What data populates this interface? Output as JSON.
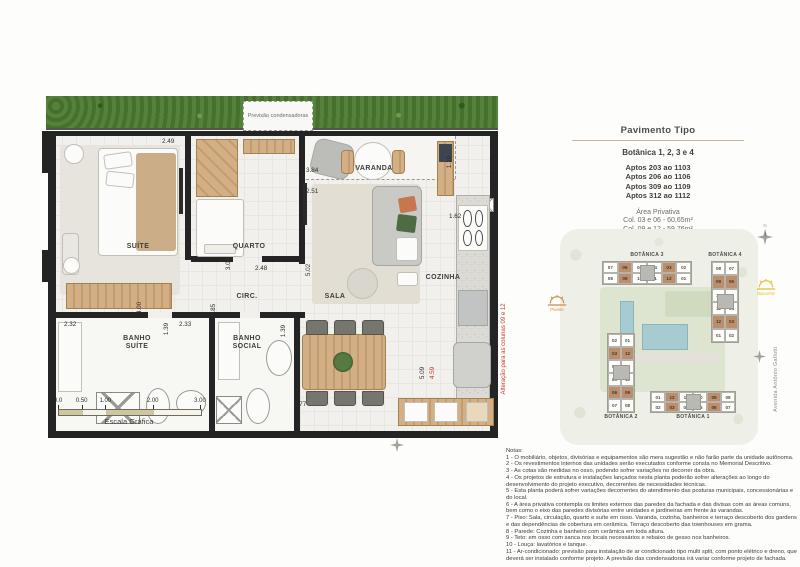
{
  "floorplan": {
    "rooms": {
      "suite": "SUÍTE",
      "quarto": "QUARTO",
      "varanda": "VARANDA",
      "sala": "SALA",
      "cozinha": "COZINHA",
      "circ": "CIRC.",
      "banho_suite": "BANHO SUÍTE",
      "banho_social": "BANHO SOCIAL"
    },
    "dims": {
      "suite_top": "2.49",
      "varanda_width": "3.84",
      "varanda_depth": "1.19",
      "sala_width": "2.51",
      "quarto_depth": "3.04",
      "quarto_width": "2.48",
      "sala_depth": "5.02",
      "circ_width": "0.85",
      "suite_depth": "4.00",
      "banho_suite_width": "2.32",
      "banho_suite_depth": "1.39",
      "banho_social_width": "2.33",
      "banho_social_depth": "1.39",
      "cozinha_width": "1.62",
      "cozinha_depth": "5.09",
      "cozinha_depth_alt": "4.59",
      "dining_width": "2.77"
    },
    "condensers_label": "Previsão condensadoras",
    "alteration_note": "Alteração para as colunas 09 e 12",
    "scale": {
      "ticks": [
        "0.0",
        "0.50",
        "1.00",
        "2.00",
        "3.00"
      ],
      "label": "Escala Gráfica"
    }
  },
  "panel": {
    "title": "Pavimento Tipo",
    "subtitle": "Botânica 1, 2, 3 e 4",
    "aptos": [
      "Aptos 203 ao 1103",
      "Aptos 206 ao 1106",
      "Aptos 309 ao 1109",
      "Aptos 312 ao 1112"
    ],
    "area_privativa": {
      "title": "Área Privativa",
      "lines": [
        "Col. 03 e 06 - 60,65m²",
        "Col. 09 e 12 - 59,76m²"
      ]
    }
  },
  "keyplan": {
    "buildings": [
      {
        "name": "BOTÂNICA 3",
        "orientation": "horizontal",
        "rows": [
          [
            "07",
            "06",
            "05",
            "04",
            "03",
            "02"
          ],
          [
            "08",
            "09",
            "10",
            "11",
            "12",
            "01"
          ]
        ],
        "highlighted": [
          "06",
          "03",
          "09",
          "12"
        ]
      },
      {
        "name": "BOTÂNICA 4",
        "orientation": "vertical",
        "rows": [
          [
            "08",
            "07"
          ],
          [
            "09",
            "06"
          ],
          [
            "10",
            "05"
          ],
          [
            "11",
            "04"
          ],
          [
            "12",
            "03"
          ],
          [
            "01",
            "02"
          ]
        ],
        "highlighted": [
          "09",
          "06",
          "12",
          "03"
        ]
      },
      {
        "name": "BOTÂNICA 2",
        "orientation": "vertical",
        "rows": [
          [
            "02",
            "01"
          ],
          [
            "03",
            "12"
          ],
          [
            "04",
            "11"
          ],
          [
            "05",
            "10"
          ],
          [
            "06",
            "09"
          ],
          [
            "07",
            "08"
          ]
        ],
        "highlighted": [
          "03",
          "12",
          "06",
          "09"
        ]
      },
      {
        "name": "BOTÂNICA 1",
        "orientation": "horizontal",
        "rows": [
          [
            "01",
            "12",
            "11",
            "10",
            "09",
            "08"
          ],
          [
            "02",
            "03",
            "04",
            "05",
            "06",
            "07"
          ]
        ],
        "highlighted": [
          "12",
          "09",
          "03",
          "06"
        ]
      }
    ],
    "street": "Avenida Antônio Gallotti",
    "sun_west": "Poente",
    "sun_east": "Nascente",
    "north": "N"
  },
  "notes": {
    "title": "Notas:",
    "items": [
      "1 - O mobiliário, objetos, divisórias e equipamentos são mera sugestão e não farão parte da unidade autônoma.",
      "2 - Os revestimentos internos das unidades serão executados conforme consta no Memorial Descritivo.",
      "3 - As cotas são medidas no osso, podendo sofrer variações no decorrer da obra.",
      "4 - Os projetos de estrutura e instalações lançados nesta planta poderão sofrer alterações ao longo do desenvolvimento do projeto executivo, decorrentes de necessidades técnicas.",
      "5 - Esta planta poderá sofrer variações decorrentes do atendimento das posturas municipais, concessionárias e do local.",
      "6 - A área privativa contempla os limites externos das paredes da fachada e das divisas com as áreas comuns, bem como o eixo das paredes divisórias entre unidades e jardineiras em frente às varandas.",
      "7 - Piso: Sala, circulação, quarto e suíte em osso. Varanda, cozinha, banheiros e terraço descoberto dos gardens e das dependências de cobertura em cerâmica. Terraço descoberto das townhouses em grama.",
      "8 - Parede: Cozinha e banheiro com cerâmica em toda altura.",
      "9 - Teto: em osso com sanca nos locais necessários e rebaixo de gesso nos banheiros.",
      "10 - Louça: lavatórios e tanque.",
      "11 - Ar-condicionado: previsão para instalação de ar condicionado tipo multi split, com ponto elétrico e dreno, que deverá ser instalado conforme projeto. A previsão das condensadoras irá variar conforme projeto de fachada."
    ]
  },
  "colors": {
    "highlight_unit": "#bb8f6d",
    "accent_rule": "#c9b797",
    "alert_red": "#c0392b",
    "wall": "#242424",
    "hedge_green": "#47702f"
  }
}
